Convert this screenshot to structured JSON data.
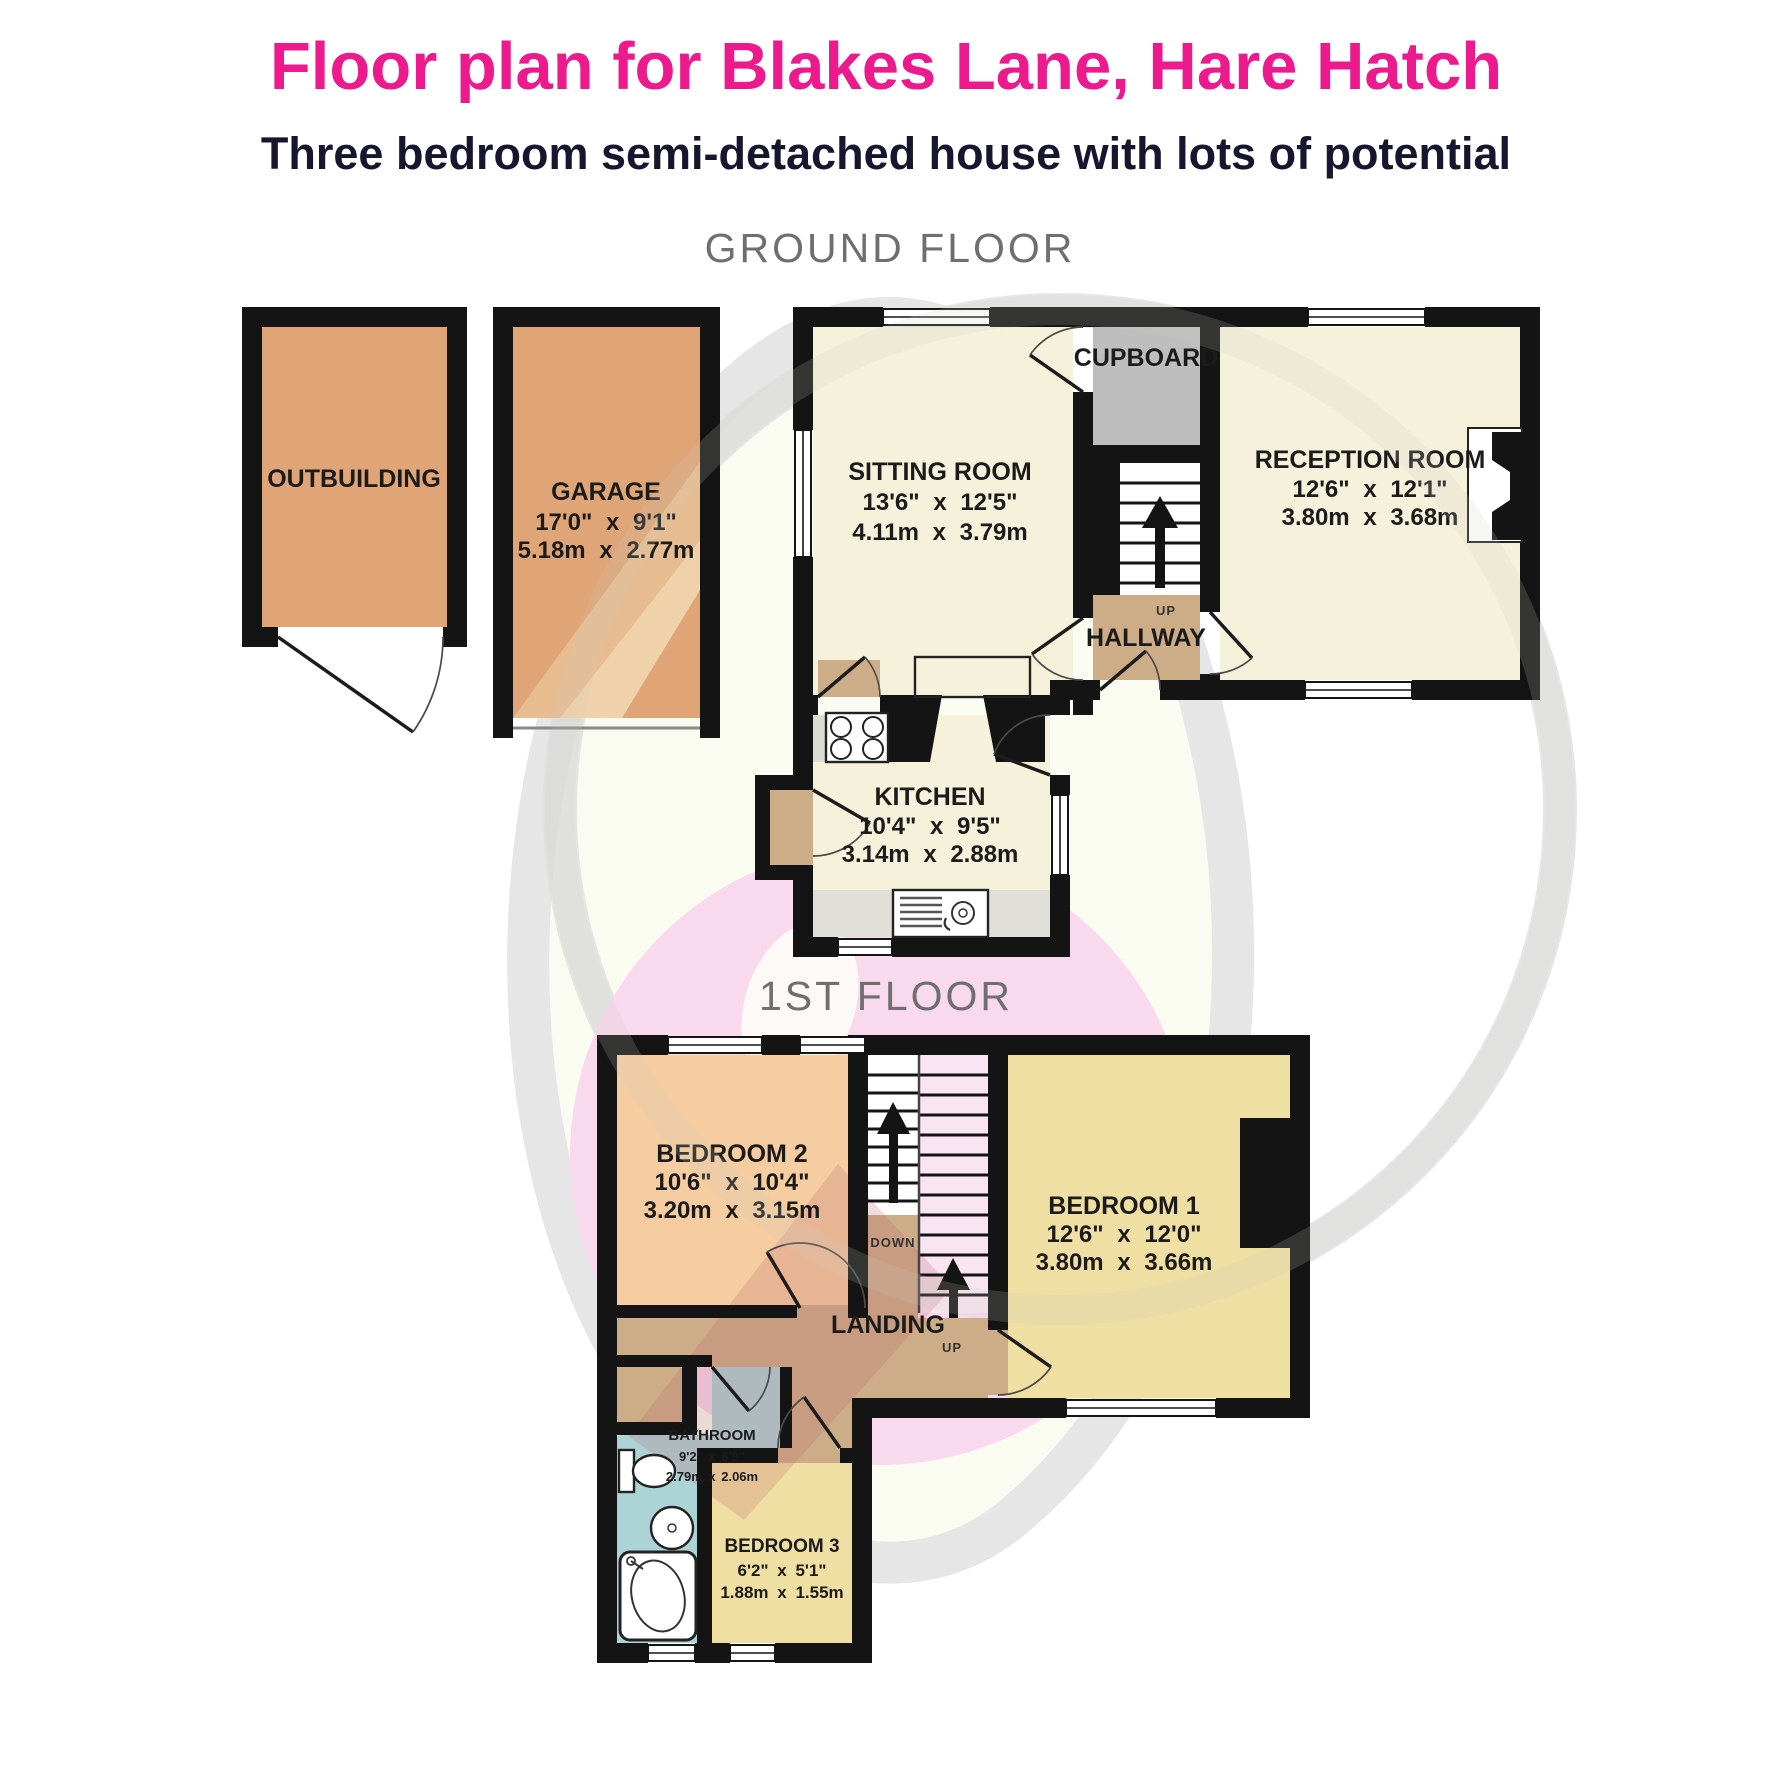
{
  "header": {
    "title": "Floor plan for Blakes Lane, Hare Hatch",
    "subtitle": "Three bedroom semi-detached house with lots of potential"
  },
  "floor_labels": {
    "ground": "GROUND FLOOR",
    "first": "1ST FLOOR"
  },
  "rooms": {
    "outbuilding": {
      "name": "OUTBUILDING"
    },
    "garage": {
      "name": "GARAGE",
      "imperial": "17'0\" x 9'1\"",
      "metric": "5.18m x 2.77m"
    },
    "sitting_room": {
      "name": "SITTING ROOM",
      "imperial": "13'6\" x 12'5\"",
      "metric": "4.11m x 3.79m"
    },
    "cupboard": {
      "name": "CUPBOARD"
    },
    "reception_room": {
      "name": "RECEPTION ROOM",
      "imperial": "12'6\" x 12'1\"",
      "metric": "3.80m x 3.68m"
    },
    "hallway": {
      "name": "HALLWAY"
    },
    "kitchen": {
      "name": "KITCHEN",
      "imperial": "10'4\" x 9'5\"",
      "metric": "3.14m x 2.88m"
    },
    "bedroom2": {
      "name": "BEDROOM 2",
      "imperial": "10'6\" x 10'4\"",
      "metric": "3.20m x 3.15m"
    },
    "bedroom1": {
      "name": "BEDROOM 1",
      "imperial": "12'6\" x 12'0\"",
      "metric": "3.80m x 3.66m"
    },
    "landing": {
      "name": "LANDING"
    },
    "bathroom": {
      "name": "BATHROOM",
      "imperial": "9'2\" x 6'9\"",
      "metric": "2.79m x 2.06m"
    },
    "bedroom3": {
      "name": "BEDROOM 3",
      "imperial": "6'2\" x 5'1\"",
      "metric": "1.88m x 1.55m"
    }
  },
  "stairs": {
    "up": "UP",
    "down": "DOWN"
  },
  "colors": {
    "accent_pink": "#EC1A8C",
    "subtitle_navy": "#16162E",
    "floor_label_gray": "#6F6F6F",
    "wall_black": "#141414",
    "cream_room": "#F6F1DA",
    "orange_room": "#DFA577",
    "cupboard_gray": "#BEBEBE",
    "hall_tan": "#CDAD87",
    "bedroom_peach": "#F6CDA0",
    "bedroom_yellow": "#F0DFA3",
    "bathroom_blue": "#ACD4D7",
    "stair_pink": "#F8E5F1",
    "watermark_pink": "#F9D9EE"
  }
}
